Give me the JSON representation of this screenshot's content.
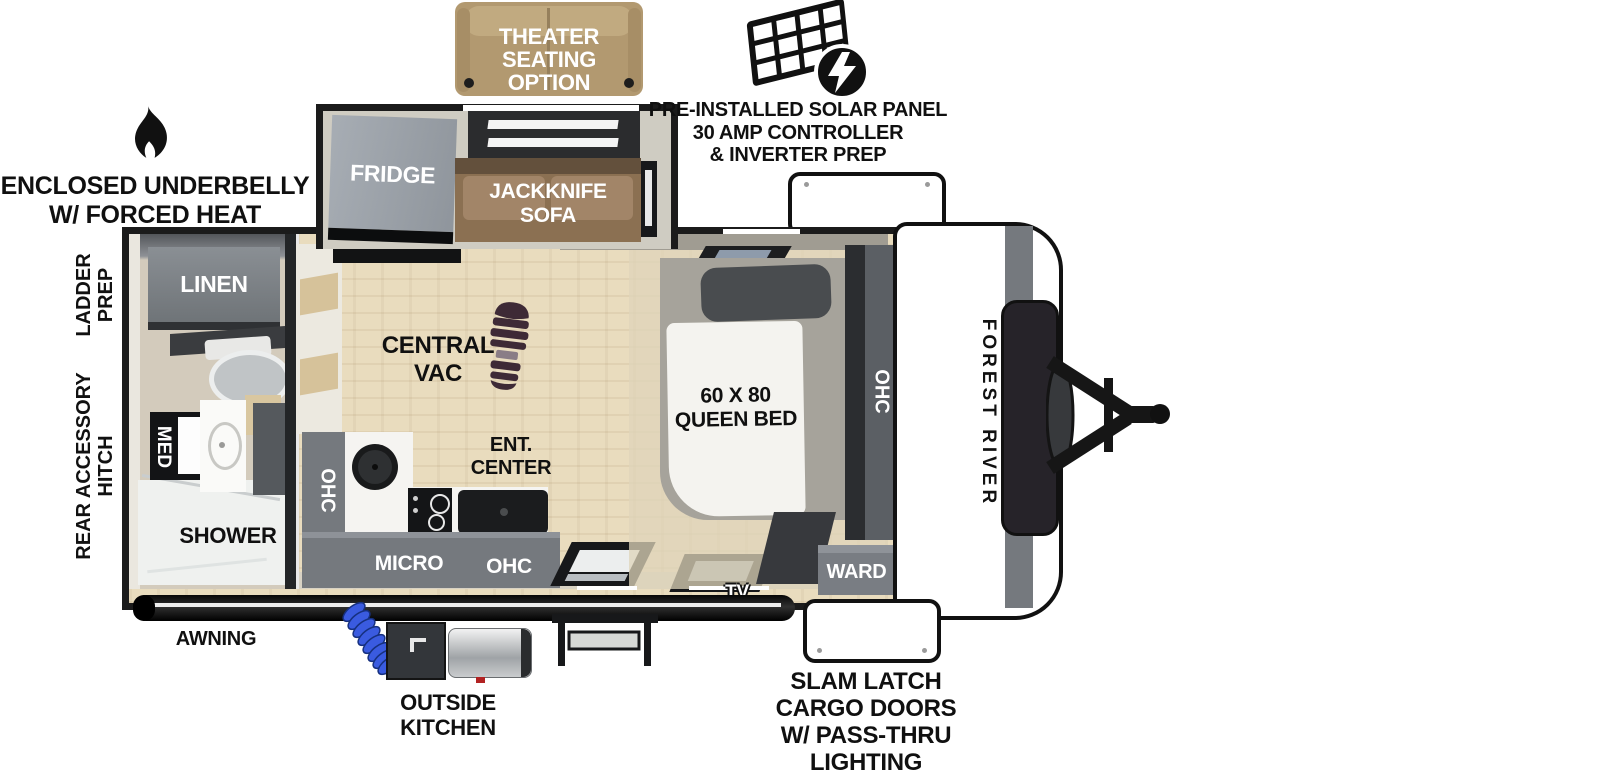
{
  "labels": {
    "theater_seating_option": "THEATER\nSEATING\nOPTION",
    "solar_panel": "PRE-INSTALLED SOLAR PANEL\n30 AMP CONTROLLER\n& INVERTER PREP",
    "enclosed_underbelly": "ENCLOSED UNDERBELLY\nW/ FORCED HEAT",
    "ladder_prep": "LADDER\nPREP",
    "rear_accessory_hitch": "REAR ACCESSORY\nHITCH",
    "awning": "AWNING",
    "outside_kitchen": "OUTSIDE\nKITCHEN",
    "slam_latch": "SLAM LATCH\nCARGO DOORS\nW/ PASS-THRU\nLIGHTING",
    "brand": "FOREST RIVER"
  },
  "interior": {
    "fridge": "FRIDGE",
    "jackknife_sofa": "JACKKNIFE\nSOFA",
    "linen": "LINEN",
    "med_cabinet": "MED",
    "shower": "SHOWER",
    "central_vac": "CENTRAL\nVAC",
    "ent_center": "ENT.\nCENTER",
    "kitchen_ohc": "OHC",
    "micro": "MICRO",
    "counter_ohc": "OHC",
    "queen_bed": "60 X 80\nQUEEN BED",
    "bedroom_ohc": "OHC",
    "wardrobe": "WARD",
    "tv": "TV"
  },
  "colors": {
    "wall_black": "#1b1b1b",
    "wood_floor": "#e9dcbe",
    "cabinet_gray": "#75797e",
    "dark_cabinet": "#3c3f43",
    "sofa_brown": "#8b7052",
    "theater_tan": "#b29970",
    "hose_blue": "#3a5be0",
    "bootprint": "#3e2a36"
  }
}
